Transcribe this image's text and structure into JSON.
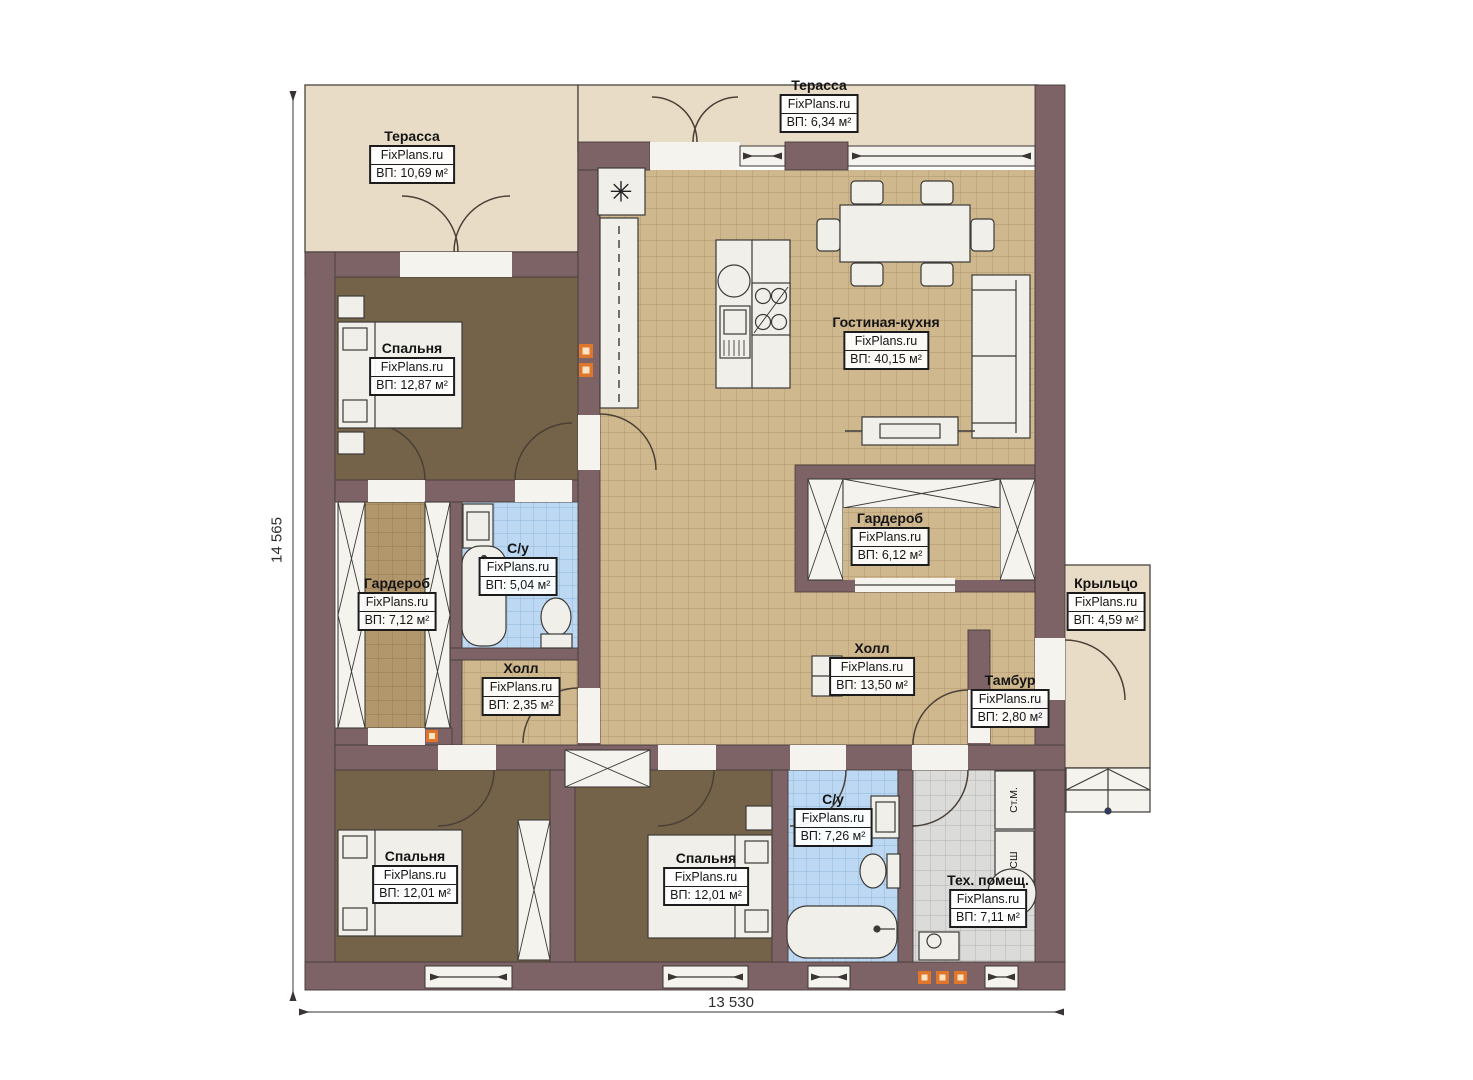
{
  "watermark": "FixPlans.ru",
  "dimensions": {
    "height_mm": "14 565",
    "width_mm": "13 530"
  },
  "rooms": [
    {
      "name": "Терасса",
      "area": "ВП: 10,69 м²"
    },
    {
      "name": "Терасса",
      "area": "ВП: 6,34 м²"
    },
    {
      "name": "Гостиная-кухня",
      "area": "ВП: 40,15 м²"
    },
    {
      "name": "Спальня",
      "area": "ВП: 12,87 м²"
    },
    {
      "name": "Гардероб",
      "area": "ВП: 7,12 м²"
    },
    {
      "name": "С/у",
      "area": "ВП: 5,04 м²"
    },
    {
      "name": "Холл",
      "area": "ВП: 2,35 м²"
    },
    {
      "name": "Гардероб",
      "area": "ВП: 6,12 м²"
    },
    {
      "name": "Холл",
      "area": "ВП: 13,50 м²"
    },
    {
      "name": "Крыльцо",
      "area": "ВП: 4,59 м²"
    },
    {
      "name": "Тамбур",
      "area": "ВП: 2,80 м²"
    },
    {
      "name": "Спальня",
      "area": "ВП: 12,01 м²"
    },
    {
      "name": "Спальня",
      "area": "ВП: 12,01 м²"
    },
    {
      "name": "С/у",
      "area": "ВП: 7,26 м²"
    },
    {
      "name": "Тех. помещ.",
      "area": "ВП: 7,11 м²"
    }
  ],
  "appliances": {
    "washing_machine": "Ст.М.",
    "drying_machine": "СШ"
  },
  "icons": {
    "ventilation": "✳"
  },
  "colors": {
    "wall": "#7d6366",
    "terrace_floor": "#e9dcc7",
    "tile_floor": "#cfb78e",
    "bedroom_floor": "#746349",
    "bathroom_tile": "#bcd8f2",
    "tech_tile": "#dbdbd9",
    "vent_marker": "#e0752c"
  }
}
